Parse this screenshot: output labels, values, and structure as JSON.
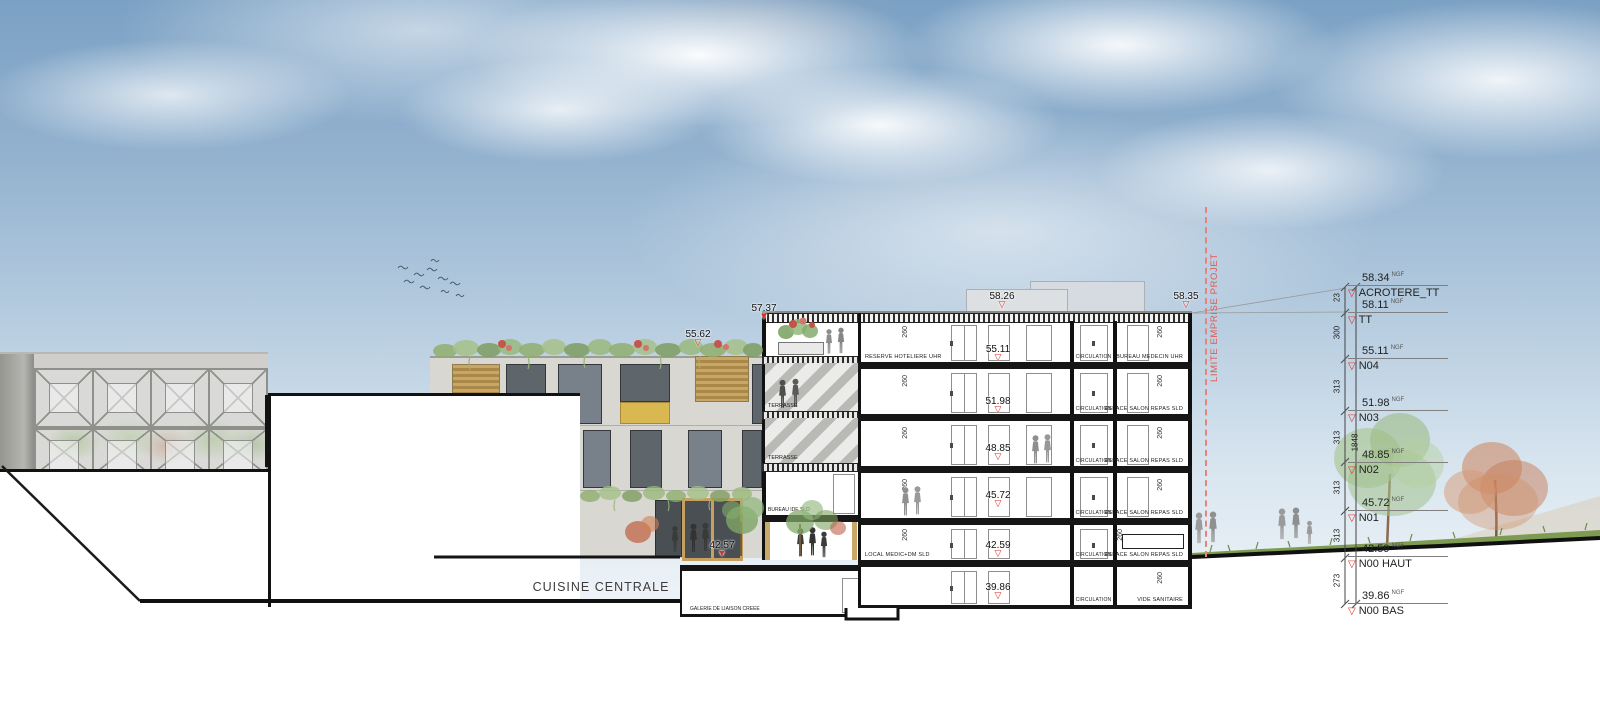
{
  "icons": {
    "tri_open": "▽",
    "tri_filled": "▼"
  },
  "annex": {
    "cuisine": "CUISINE CENTRALE",
    "galerie": "GALERIE DE LIAISON CREEE",
    "limite": "LIMITE EMPRISE PROJET",
    "terrasse_upper": "TERRASSE",
    "terrasse_lower": "TERRASSE",
    "bureau_ide": "BUREAU IDE SLD"
  },
  "roof_markers": {
    "r5826": "58.26",
    "r5835": "58.35",
    "r5737": "57.37",
    "r5562": "55.62",
    "r4257": "42.57"
  },
  "floors": [
    {
      "level": "55.11",
      "left_room": "RESERVE HOTELIERE UHR",
      "circulation": "CIRCULATION",
      "right_room": "BUREAU MEDECIN UHR",
      "left_height": "260",
      "right_height": "260"
    },
    {
      "level": "51.98",
      "left_room": "",
      "circulation": "CIRCULATION",
      "right_room": "ESPACE SALON REPAS SLD",
      "left_height": "260",
      "right_height": "260"
    },
    {
      "level": "48.85",
      "left_room": "",
      "circulation": "CIRCULATION",
      "right_room": "ESPACE SALON REPAS SLD",
      "left_height": "260",
      "right_height": "260"
    },
    {
      "level": "45.72",
      "left_room": "",
      "circulation": "CIRCULATION",
      "right_room": "ESPACE SALON REPAS SLD",
      "left_height": "260",
      "right_height": "260"
    },
    {
      "level": "42.59",
      "left_room": "LOCAL MEDIC+DM SLD",
      "circulation": "CIRCULATION",
      "right_room": "ESPACE SALON REPAS SLD",
      "left_height": "260",
      "right_height": "260"
    },
    {
      "level": "39.86",
      "left_room": "",
      "circulation": "CIRCULATION",
      "right_room": "VIDE SANITAIRE",
      "left_height": "",
      "right_height": "260"
    }
  ],
  "right_levels": [
    {
      "value": "58.34",
      "unit": "NGF",
      "name": "ACROTERE_TT"
    },
    {
      "value": "58.11",
      "unit": "NGF",
      "name": "TT"
    },
    {
      "value": "55.11",
      "unit": "NGF",
      "name": "N04"
    },
    {
      "value": "51.98",
      "unit": "NGF",
      "name": "N03"
    },
    {
      "value": "48.85",
      "unit": "NGF",
      "name": "N02"
    },
    {
      "value": "45.72",
      "unit": "NGF",
      "name": "N01"
    },
    {
      "value": "42.59",
      "unit": "NGF",
      "name": "N00 HAUT"
    },
    {
      "value": "39.86",
      "unit": "NGF",
      "name": "N00 BAS"
    }
  ],
  "dim_chain": {
    "segments": [
      "23",
      "300",
      "313",
      "313",
      "313",
      "313",
      "273"
    ],
    "total": "1848"
  }
}
